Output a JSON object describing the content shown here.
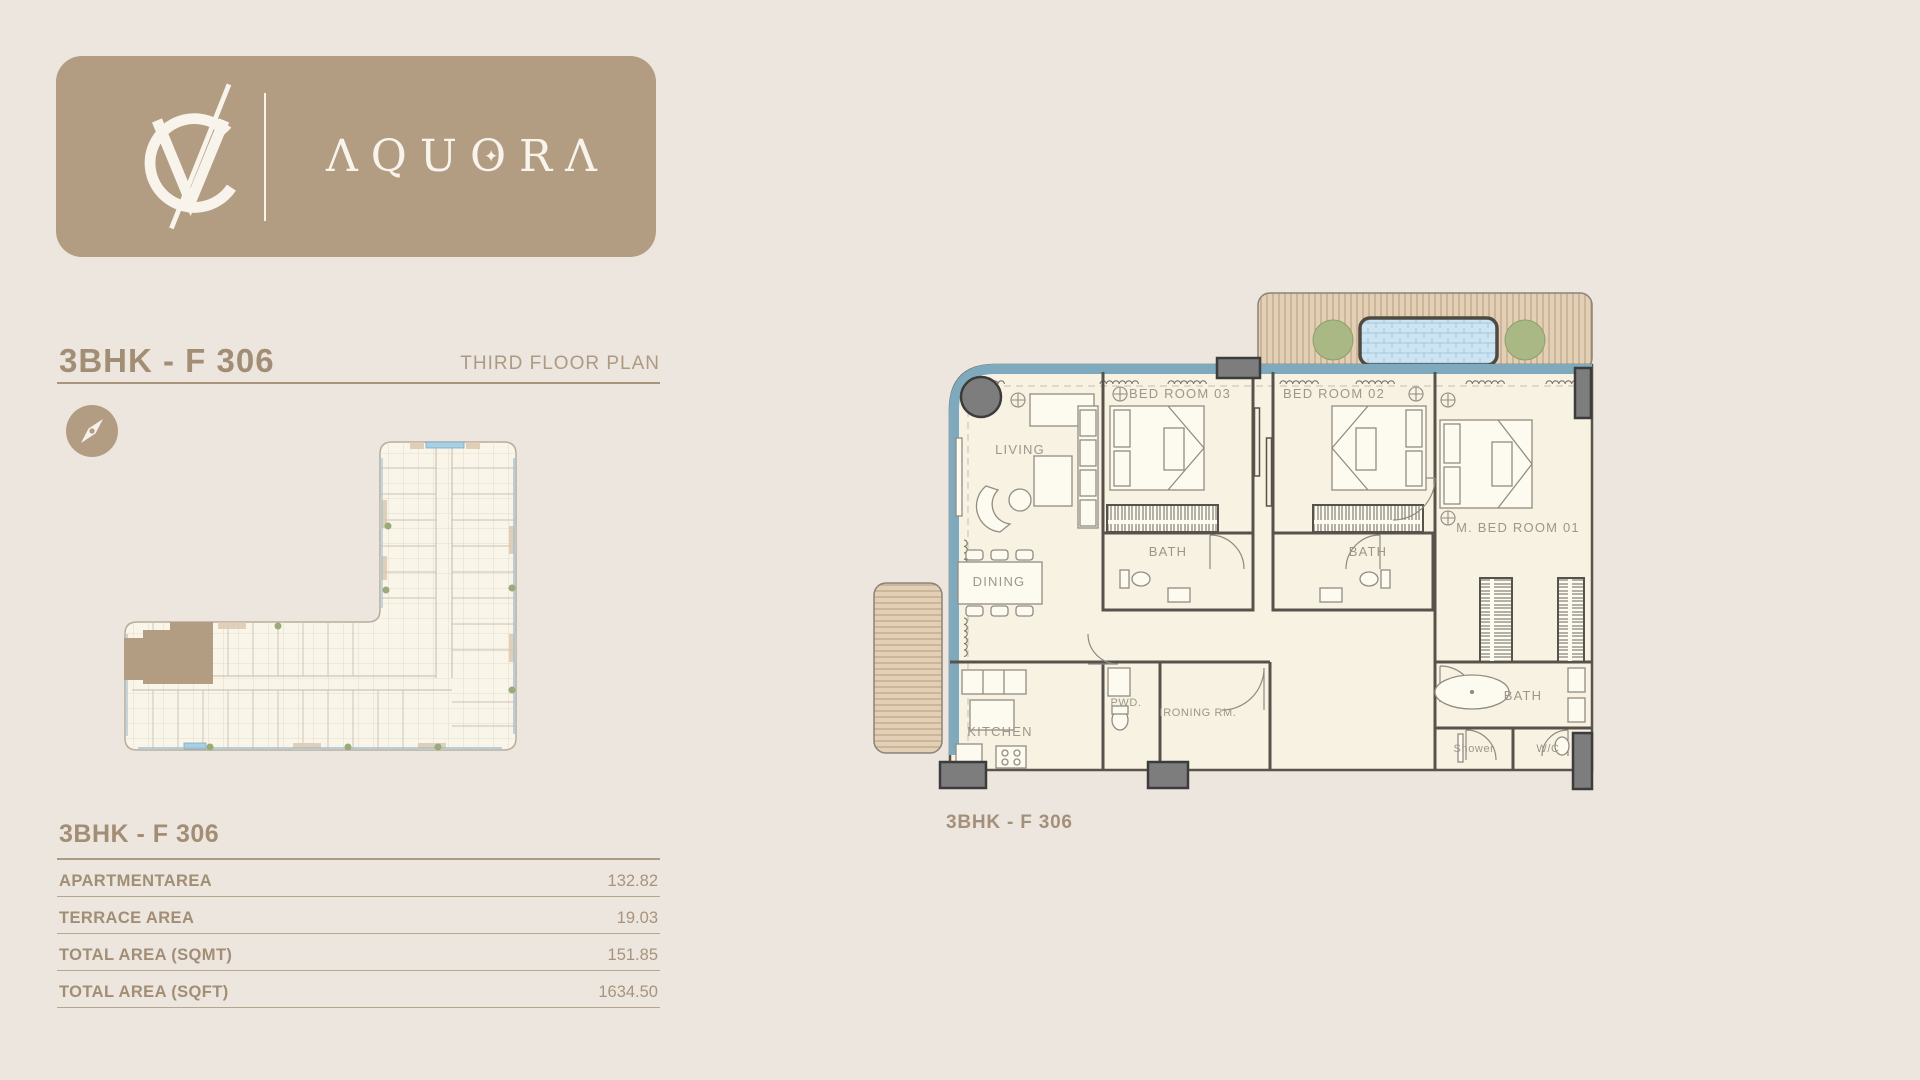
{
  "brand": {
    "name": "AQUORA",
    "monogram": "VC",
    "wordmark_pre": "ΛQU",
    "wordmark_o": "O",
    "wordmark_star": "✦",
    "wordmark_post": "RΛ"
  },
  "header": {
    "title": "3BHK - F 306",
    "subtitle": "THIRD FLOOR PLAN"
  },
  "area_table": {
    "title": "3BHK - F 306",
    "rows": [
      {
        "label": "APARTMENTAREA",
        "value": "132.82"
      },
      {
        "label": "TERRACE AREA",
        "value": "19.03"
      },
      {
        "label": "TOTAL AREA (SQMT)",
        "value": "151.85"
      },
      {
        "label": "TOTAL AREA (SQFT)",
        "value": "1634.50"
      }
    ]
  },
  "floor_plan": {
    "caption": "3BHK - F 306",
    "labels": {
      "living": "LIVING",
      "dining": "DINING",
      "kitchen": "KITCHEN",
      "bedroom3": "BED ROOM 03",
      "bedroom2": "BED ROOM 02",
      "master": "M. BED ROOM 01",
      "bath": "BATH",
      "pwd": "PWD.",
      "ironing": "IRONING RM.",
      "shower": "Shower",
      "wc": "W/C"
    }
  },
  "colors": {
    "page_bg": "#ece6de",
    "accent_tan": "#b29d83",
    "heading_tan": "#a28e75",
    "glass_blue": "#7fa9bd",
    "pool_blue": "#cde5f2",
    "deck_wood": "#e2cfb6",
    "tree_green": "#a9b884",
    "wall_dark": "#57524b"
  }
}
